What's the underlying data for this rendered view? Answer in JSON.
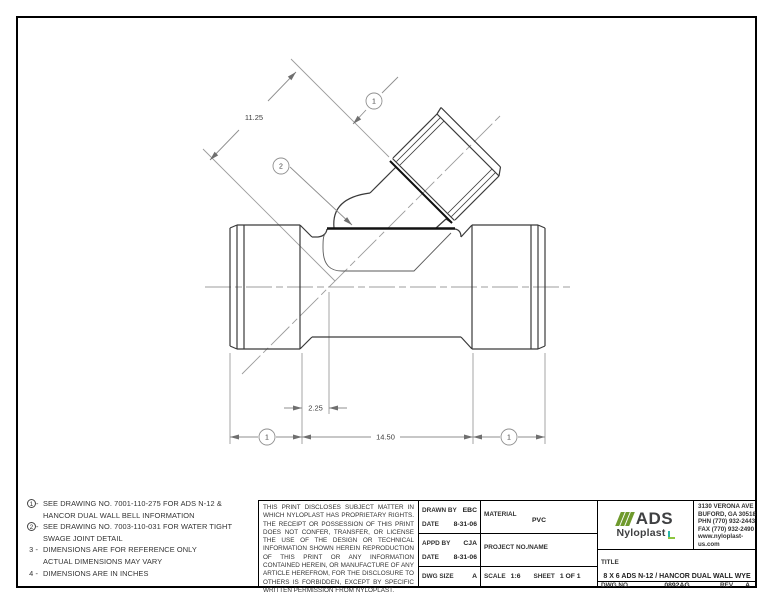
{
  "drawing": {
    "dims": {
      "branch": "11.25",
      "offset": "2.25",
      "length": "14.50"
    },
    "balloons": {
      "top": "1",
      "swage": "2",
      "bottom_left": "1",
      "bottom_right": "1"
    },
    "line_color": "#3a3a3a",
    "dim_color": "#8f8f8f",
    "joint_color": "#111111"
  },
  "notes": [
    {
      "num": "1",
      "circled": true,
      "line1": "SEE DRAWING NO. 7001-110-275 FOR ADS N-12 &",
      "line2": "HANCOR DUAL WALL BELL INFORMATION"
    },
    {
      "num": "2",
      "circled": true,
      "line1": "SEE DRAWING NO. 7003-110-031 FOR WATER TIGHT",
      "line2": "SWAGE JOINT DETAIL"
    },
    {
      "num": "3",
      "circled": false,
      "line1": "DIMENSIONS ARE FOR REFERENCE ONLY",
      "line2": "ACTUAL DIMENSIONS MAY VARY"
    },
    {
      "num": "4",
      "circled": false,
      "line1": "DIMENSIONS ARE IN INCHES",
      "line2": ""
    }
  ],
  "disclaimer": "THIS PRINT DISCLOSES SUBJECT MATTER IN WHICH NYLOPLAST HAS PROPRIETARY RIGHTS.  THE RECEIPT OR POSSESSION OF THIS PRINT DOES NOT CONFER, TRANSFER, OR LICENSE THE USE OF THE DESIGN OR TECHNICAL INFORMATION SHOWN HEREIN REPRODUCTION OF THIS PRINT OR ANY INFORMATION CONTAINED HEREIN, OR MANUFACTURE OF ANY ARTICLE HEREFROM, FOR THE DISCLOSURE TO OTHERS IS FORBIDDEN, EXCEPT BY SPECIFIC WRITTEN PERMISSION FROM NYLOPLAST.",
  "title_block": {
    "drawn_by_label": "DRAWN BY",
    "drawn_by": "EBC",
    "date1_label": "DATE",
    "date1": "8-31-06",
    "appd_by_label": "APPD BY",
    "appd_by": "CJA",
    "date2_label": "DATE",
    "date2": "8-31-06",
    "dwg_size_label": "DWG SIZE",
    "dwg_size": "A",
    "material_label": "MATERIAL",
    "material": "PVC",
    "project_label": "PROJECT NO./NAME",
    "scale_label": "SCALE",
    "scale": "1:6",
    "sheet_label": "SHEET",
    "sheet": "1 OF 1",
    "title_label": "TITLE",
    "title": "8 X 6 ADS N-12 / HANCOR DUAL WALL WYE",
    "dwg_no_label": "DWG NO.",
    "dwg_no": "0892AG",
    "rev_label": "REV",
    "rev": "A"
  },
  "logo": {
    "ads": "ADS",
    "nyloplast": "Nyloplast",
    "stripe_color": "#6f9a2d",
    "text_color": "#3f4042",
    "teal": "#29b5aa",
    "green": "#8dc63f"
  },
  "address": {
    "line1": "3130 VERONA AVE",
    "line2": "BUFORD, GA 30518",
    "line3": "PHN (770) 932-2443",
    "line4": "FAX (770) 932-2490",
    "line5": "www.nyloplast-us.com"
  }
}
